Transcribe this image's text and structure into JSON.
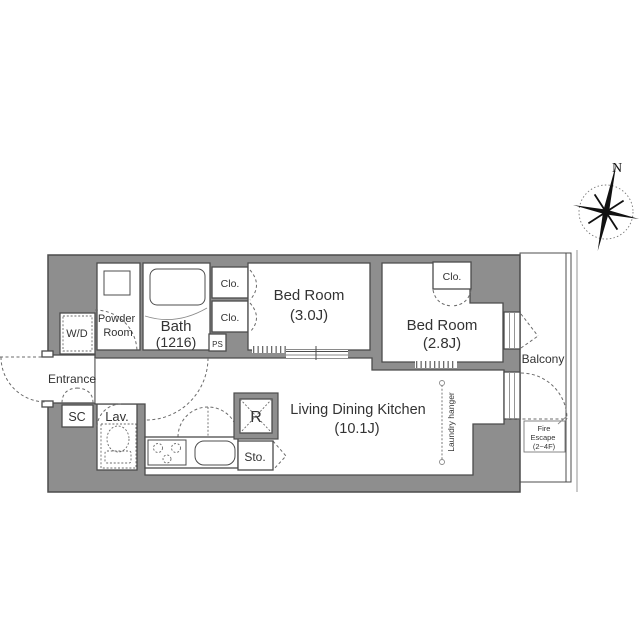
{
  "page": {
    "background": "#ffffff"
  },
  "colors": {
    "wall_fill": "#8e8e8e",
    "wall_line": "#4c4c4c",
    "dashed_line": "#6b6b6b",
    "text": "#333333"
  },
  "compass": {
    "north_label": "N"
  },
  "rooms": {
    "powder_room": {
      "line1": "Powder",
      "line2": "Room"
    },
    "bath": {
      "name": "Bath",
      "size": "(1216)"
    },
    "bedroom_1": {
      "name": "Bed Room",
      "size": "(3.0J)"
    },
    "bedroom_2": {
      "name": "Bed Room",
      "size": "(2.8J)"
    },
    "living_dining_kitchen": {
      "name": "Living Dining Kitchen",
      "size": "(10.1J)"
    },
    "entrance": {
      "name": "Entrance"
    },
    "lavatory": {
      "name": "Lav."
    },
    "balcony": {
      "name": "Balcony"
    }
  },
  "features": {
    "closet_1": "Clo.",
    "closet_2": "Clo.",
    "closet_3": "Clo.",
    "pipe_space": "PS",
    "shoe_closet": "SC",
    "washer_dryer": "W/D",
    "refrigerator": "R",
    "storage": "Sto.",
    "laundry_hanger": "Laundry hanger",
    "fire_escape": {
      "line1": "Fire",
      "line2": "Escape",
      "line3": "(2~4F)"
    }
  }
}
